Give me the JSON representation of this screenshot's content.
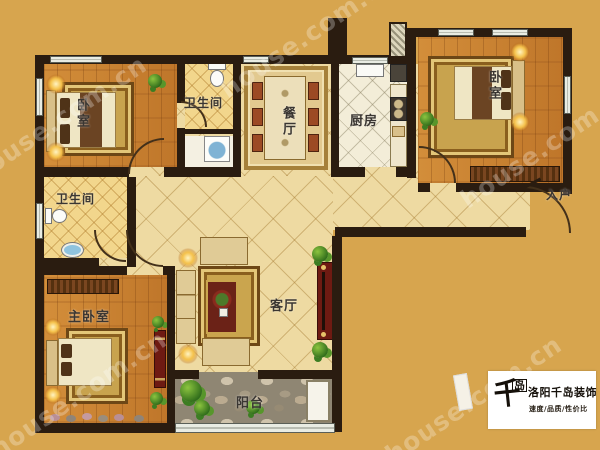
{
  "rooms": [
    {
      "name": "bedroom-top-left",
      "label": "卧室"
    },
    {
      "name": "bathroom-top",
      "label": "卫生间"
    },
    {
      "name": "dining-room",
      "label": "餐厅"
    },
    {
      "name": "kitchen",
      "label": "厨房"
    },
    {
      "name": "bedroom-top-right",
      "label": "卧室"
    },
    {
      "name": "bathroom-middle",
      "label": "卫生间"
    },
    {
      "name": "master-bedroom",
      "label": "主卧室"
    },
    {
      "name": "living-room",
      "label": "客厅"
    },
    {
      "name": "balcony",
      "label": "阳台"
    },
    {
      "name": "entry",
      "label": "入户"
    }
  ],
  "watermark": {
    "text": "house.com.cn"
  },
  "logo": {
    "mark_main": "千",
    "mark_small": "岛",
    "brand": "洛阳千岛装饰",
    "slogan": "速度/品质/性价比"
  },
  "colors": {
    "background": "#d7a54e",
    "wall": "#2a1c10",
    "wood_floor": "#c8812f",
    "hall_tile": "#eedaa2",
    "bath_tile": "#f2d68c",
    "kitchen_tile": "#f3edd8",
    "balcony_stone": "#8f8673",
    "tv_cabinet_red": "#6e1a12"
  }
}
